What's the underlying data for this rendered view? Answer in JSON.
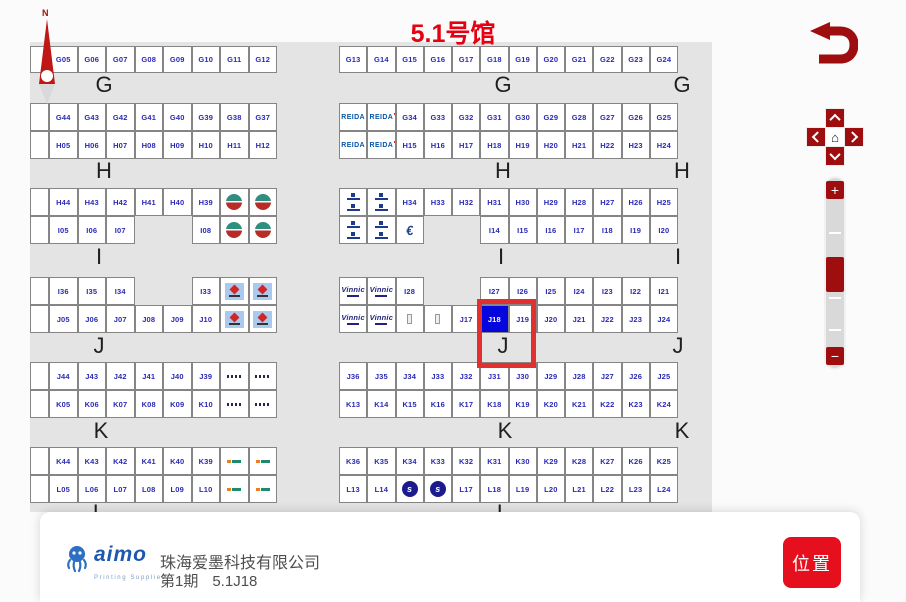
{
  "title": "5.1号馆",
  "compass": {
    "label": "N"
  },
  "icons": {
    "home": "⌂",
    "zoom_in": "+",
    "zoom_out": "−"
  },
  "footer": {
    "logo_text": "aimo",
    "logo_sub": "Printing Supplies",
    "company": "珠海爱墨科技有限公司",
    "phase": "第1期",
    "booth": "5.1J18",
    "action": "位置"
  },
  "colors": {
    "title_red": "#e60012",
    "control_red": "#9e0e0e",
    "booth_text": "#2a2ab5",
    "selected_booth_bg": "#0505dd",
    "highlight_red": "#e23030",
    "panel_gray": "#e4e4e4",
    "button_red": "#e60f1e"
  },
  "map": {
    "selected_booth": "J18",
    "highlight": {
      "x": 477,
      "y": 299,
      "w": 49,
      "h": 59
    },
    "section_labels": [
      {
        "t": "G",
        "x": 92,
        "y": 72
      },
      {
        "t": "G",
        "x": 491,
        "y": 72
      },
      {
        "t": "G",
        "x": 670,
        "y": 72
      },
      {
        "t": "H",
        "x": 92,
        "y": 158
      },
      {
        "t": "H",
        "x": 491,
        "y": 158
      },
      {
        "t": "H",
        "x": 670,
        "y": 158
      },
      {
        "t": "I",
        "x": 87,
        "y": 244
      },
      {
        "t": "I",
        "x": 489,
        "y": 244
      },
      {
        "t": "I",
        "x": 666,
        "y": 244
      },
      {
        "t": "J",
        "x": 87,
        "y": 333
      },
      {
        "t": "J",
        "x": 491,
        "y": 333
      },
      {
        "t": "J",
        "x": 666,
        "y": 333
      },
      {
        "t": "K",
        "x": 89,
        "y": 418
      },
      {
        "t": "K",
        "x": 493,
        "y": 418
      },
      {
        "t": "K",
        "x": 670,
        "y": 418
      },
      {
        "t": "L",
        "x": 87,
        "y": 500
      },
      {
        "t": "L",
        "x": 491,
        "y": 500
      }
    ],
    "rows": [
      {
        "x": 30,
        "y": 46,
        "w": 28.5,
        "h": 27,
        "cells": [
          {
            "w": 19
          },
          "G05",
          "G06",
          "G07",
          "G08",
          "G09",
          "G10",
          "G11",
          "G12"
        ]
      },
      {
        "x": 339,
        "y": 46,
        "w": 28.25,
        "h": 27,
        "cells": [
          "G13",
          "G14",
          "G15",
          "G16",
          "G17",
          "G18",
          "G19",
          "G20",
          "G21",
          "G22",
          "G23",
          "G24"
        ]
      },
      {
        "x": 30,
        "y": 103,
        "w": 28.5,
        "h": 28,
        "cells": [
          {
            "w": 19
          },
          "G44",
          "G43",
          "G42",
          "G41",
          "G40",
          "G39",
          "G38",
          "G37"
        ]
      },
      {
        "x": 339,
        "y": 103,
        "w": 28.25,
        "h": 28,
        "cells": [
          {
            "logo": "reida"
          },
          {
            "logo": "reida"
          },
          "G34",
          "G33",
          "G32",
          "G31",
          "G30",
          "G29",
          "G28",
          "G27",
          "G26",
          "G25"
        ]
      },
      {
        "x": 30,
        "y": 131,
        "w": 28.5,
        "h": 28,
        "cells": [
          {
            "w": 19
          },
          "H05",
          "H06",
          "H07",
          "H08",
          "H09",
          "H10",
          "H11",
          "H12"
        ]
      },
      {
        "x": 339,
        "y": 131,
        "w": 28.25,
        "h": 28,
        "cells": [
          {
            "logo": "reida"
          },
          {
            "logo": "reida"
          },
          "H15",
          "H16",
          "H17",
          "H18",
          "H19",
          "H20",
          "H21",
          "H22",
          "H23",
          "H24"
        ]
      },
      {
        "x": 30,
        "y": 188,
        "w": 28.5,
        "h": 28,
        "cells": [
          {
            "w": 19
          },
          "H44",
          "H43",
          "H42",
          "H41",
          "H40",
          "H39",
          {
            "logo": "globe"
          },
          {
            "logo": "globe"
          }
        ]
      },
      {
        "x": 339,
        "y": 188,
        "w": 28.25,
        "h": 28,
        "cells": [
          {
            "logo": "tag2"
          },
          {
            "logo": "tag2"
          },
          "H34",
          "H33",
          "H32",
          "H31",
          "H30",
          "H29",
          "H28",
          "H27",
          "H26",
          "H25"
        ]
      },
      {
        "x": 30,
        "y": 216,
        "w": 28.5,
        "h": 28,
        "cells": [
          {
            "w": 19
          },
          "I05",
          "I06",
          "I07",
          null,
          null,
          "I08",
          {
            "logo": "globe"
          },
          {
            "logo": "globe"
          }
        ]
      },
      {
        "x": 339,
        "y": 216,
        "w": 28.25,
        "h": 28,
        "cells": [
          {
            "logo": "tag2"
          },
          {
            "logo": "tag2"
          },
          {
            "logo": "euro"
          },
          null,
          null,
          "I14",
          "I15",
          "I16",
          "I17",
          "I18",
          "I19",
          "I20"
        ]
      },
      {
        "x": 30,
        "y": 277,
        "w": 28.5,
        "h": 28,
        "cells": [
          {
            "w": 19
          },
          "I36",
          "I35",
          "I34",
          null,
          null,
          "I33",
          {
            "logo": "redarrow"
          },
          {
            "logo": "redarrow"
          }
        ]
      },
      {
        "x": 339,
        "y": 277,
        "w": 28.25,
        "h": 28,
        "cells": [
          {
            "logo": "vinnic"
          },
          {
            "logo": "vinnic"
          },
          "I28",
          null,
          null,
          "I27",
          "I26",
          "I25",
          "I24",
          "I23",
          "I22",
          "I21"
        ]
      },
      {
        "x": 30,
        "y": 305,
        "w": 28.5,
        "h": 28,
        "cells": [
          {
            "w": 19
          },
          "J05",
          "J06",
          "J07",
          "J08",
          "J09",
          "J10",
          {
            "logo": "redarrow"
          },
          {
            "logo": "redarrow"
          }
        ]
      },
      {
        "x": 339,
        "y": 305,
        "w": 28.25,
        "h": 28,
        "cells": [
          {
            "logo": "vinnic"
          },
          {
            "logo": "vinnic"
          },
          {
            "logo": "pole"
          },
          {
            "logo": "pole"
          },
          "J17",
          {
            "t": "J18",
            "sel": 1
          },
          "J19",
          "J20",
          "J21",
          "J22",
          "J23",
          "J24"
        ]
      },
      {
        "x": 30,
        "y": 362,
        "w": 28.5,
        "h": 28,
        "cells": [
          {
            "w": 19
          },
          "J44",
          "J43",
          "J42",
          "J41",
          "J40",
          "J39",
          {
            "logo": "darkmini"
          },
          {
            "logo": "darkmini"
          }
        ]
      },
      {
        "x": 339,
        "y": 362,
        "w": 28.25,
        "h": 28,
        "cells": [
          "J36",
          "J35",
          "J34",
          "J33",
          "J32",
          "J31",
          "J30",
          "J29",
          "J28",
          "J27",
          "J26",
          "J25"
        ]
      },
      {
        "x": 30,
        "y": 390,
        "w": 28.5,
        "h": 28,
        "cells": [
          {
            "w": 19
          },
          "K05",
          "K06",
          "K07",
          "K08",
          "K09",
          "K10",
          {
            "logo": "darkmini"
          },
          {
            "logo": "darkmini"
          }
        ]
      },
      {
        "x": 339,
        "y": 390,
        "w": 28.25,
        "h": 28,
        "cells": [
          "K13",
          "K14",
          "K15",
          "K16",
          "K17",
          "K18",
          "K19",
          "K20",
          "K21",
          "K22",
          "K23",
          "K24"
        ]
      },
      {
        "x": 30,
        "y": 447,
        "w": 28.5,
        "h": 28,
        "cells": [
          {
            "w": 19
          },
          "K44",
          "K43",
          "K42",
          "K41",
          "K40",
          "K39",
          {
            "logo": "colormini"
          },
          {
            "logo": "colormini"
          }
        ]
      },
      {
        "x": 339,
        "y": 447,
        "w": 28.25,
        "h": 28,
        "cells": [
          "K36",
          "K35",
          "K34",
          "K33",
          "K32",
          "K31",
          "K30",
          "K29",
          "K28",
          "K27",
          "K26",
          "K25"
        ]
      },
      {
        "x": 30,
        "y": 475,
        "w": 28.5,
        "h": 28,
        "cells": [
          {
            "w": 19
          },
          "L05",
          "L06",
          "L07",
          "L08",
          "L09",
          "L10",
          {
            "logo": "colormini"
          },
          {
            "logo": "colormini"
          }
        ]
      },
      {
        "x": 339,
        "y": 475,
        "w": 28.25,
        "h": 28,
        "cells": [
          "L13",
          "L14",
          {
            "logo": "bluecircle"
          },
          {
            "logo": "bluecircle"
          },
          "L17",
          "L18",
          "L19",
          "L20",
          "L21",
          "L22",
          "L23",
          "L24"
        ]
      }
    ]
  }
}
